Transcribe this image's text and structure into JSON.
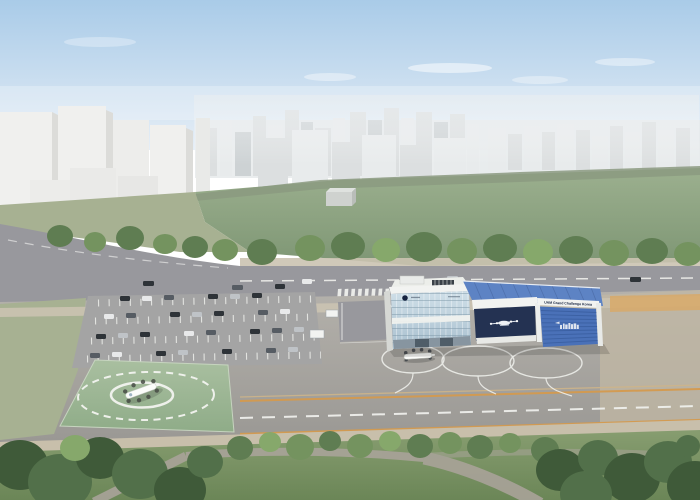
{
  "building": {
    "signage": "UAM Grand Challenge Korea"
  },
  "icons": {
    "helipad_aircraft": "evtol-aircraft-icon",
    "apron_aircraft": "evtol-aircraft-icon",
    "facade_graphic": "evtol-silhouette-icon",
    "hangar_graphic": "aircraft-skyline-icon",
    "operator_logo": "round-logo-icon"
  },
  "colors": {
    "sky_top": "#a9cbe8",
    "sky_bottom": "#e6eef6",
    "haze": "#e9edf0",
    "city_far": "#e8ebec",
    "city_mid": "#dcdfe0",
    "city_dark": "#cdd2d4",
    "massing_front": "#f0f0ee",
    "massing_side": "#dcdcd9",
    "field_light": "#9cb08f",
    "field_dark": "#7e9674",
    "treeband": "#8b9a80",
    "tree_dark": "#5f7d52",
    "tree_mid": "#74935f",
    "tree_light": "#86a86b",
    "road": "#98989d",
    "sidewalk_tan": "#cbc3b1",
    "orange_band": "#d8a968",
    "apron_light": "#b4b1ab",
    "apron_dark": "#9a9894",
    "apron_beige": "#c2b8a4",
    "left_grass": "#a7b192",
    "parking": "#a4a4a4",
    "marking": "#f2f3ef",
    "runway_orange": "#d49a4e",
    "runway_tan": "#cdb489",
    "pad_light": "#a9bfa0",
    "pad_dark": "#8fac88",
    "building_white": "#f2f3f1",
    "building_shade": "#d6d8d4",
    "glass_top": "#cfdfe8",
    "glass_bottom": "#a9c0cf",
    "navy": "#243252",
    "logo_navy": "#16233f",
    "roof_blue": "#5d83c4",
    "roof_rib": "#46659f",
    "door_blue": "#4a71b8",
    "door_rib": "#385d9e",
    "park_light": "#879d70",
    "park_dark": "#6b8657",
    "park_tree_dark": "#3f5a39",
    "park_tree_mid": "#52704a",
    "path": "#a9a399",
    "tan_strip": "#c8bfab",
    "car_dark": "#2e3338",
    "car_gray": "#565c63",
    "car_white": "#e8e9ea",
    "car_silver": "#bfc3c7"
  }
}
